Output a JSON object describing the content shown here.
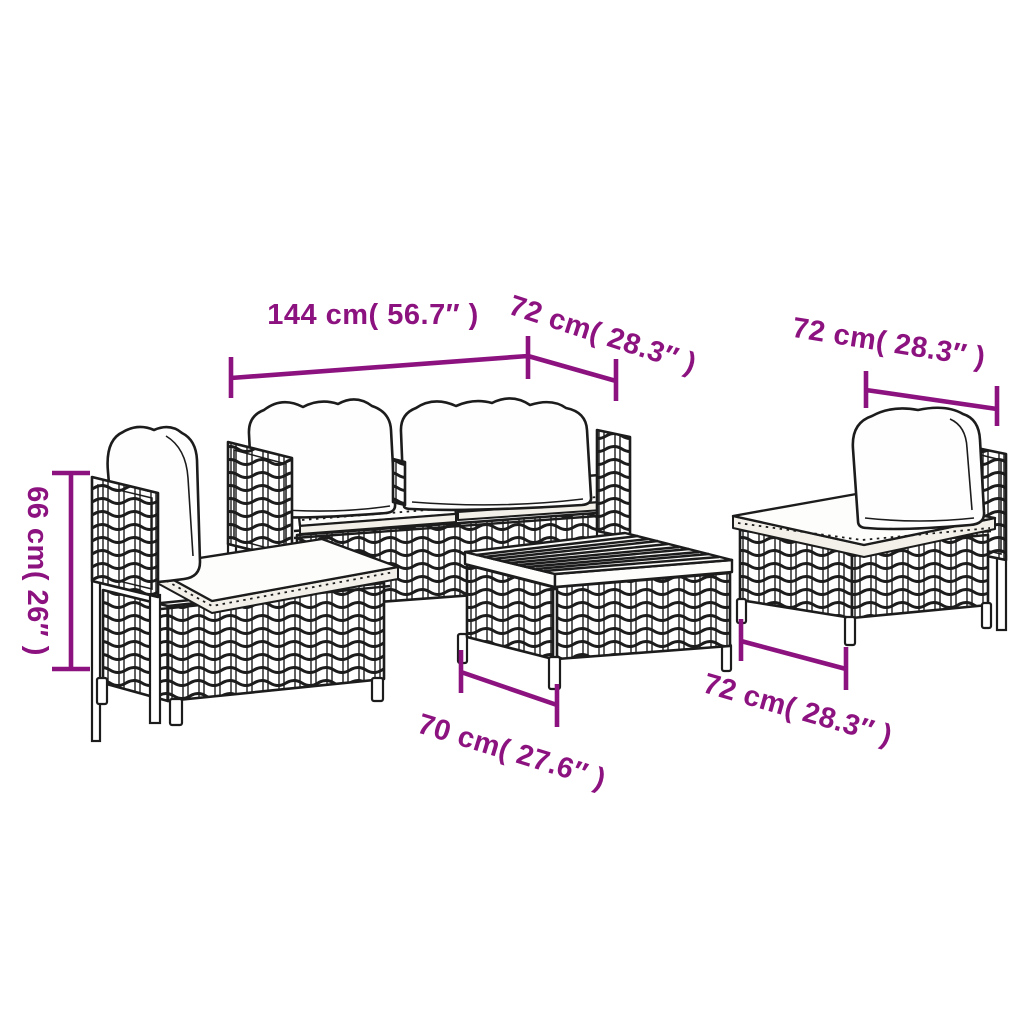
{
  "canvas": {
    "width": 1024,
    "height": 1024,
    "background": "#ffffff"
  },
  "style": {
    "line_ink": "#1c1c1c",
    "dimension_color": "#8c1280",
    "cushion_white": "#fefefe"
  },
  "dimensions": {
    "sofa_width": {
      "label": "144 cm( 56.7″ )",
      "cm": "144 cm",
      "inches": "56.7″"
    },
    "sofa_depth": {
      "label": "72 cm( 28.3″ )",
      "cm": "72 cm",
      "inches": "28.3″"
    },
    "chair_width": {
      "label": "72 cm( 28.3″ )",
      "cm": "72 cm",
      "inches": "28.3″"
    },
    "module_height": {
      "label": "66 cm( 26″ )",
      "cm": "66 cm",
      "inches": "26″"
    },
    "table_width": {
      "label": "70 cm( 27.6″ )",
      "cm": "70 cm",
      "inches": "27.6″"
    },
    "chair_depth": {
      "label": "72 cm( 28.3″ )",
      "cm": "72 cm",
      "inches": "28.3″"
    }
  },
  "furniture": {
    "pieces": [
      {
        "name": "two-seater-rattan-sofa"
      },
      {
        "name": "rattan-sofa-middle-module-left"
      },
      {
        "name": "rattan-sofa-middle-module-right"
      },
      {
        "name": "rattan-coffee-table"
      }
    ]
  }
}
